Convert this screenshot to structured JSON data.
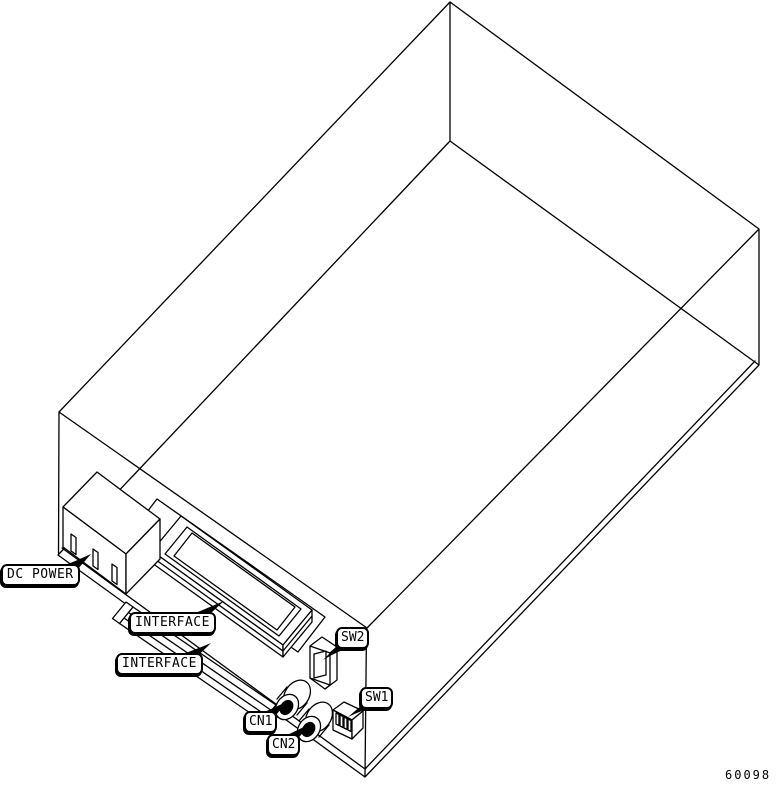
{
  "figure": {
    "number": "60098",
    "callouts": {
      "dc_power": "DC POWER",
      "interface_upper": "INTERFACE",
      "interface_lower": "INTERFACE",
      "sw2": "SW2",
      "sw1": "SW1",
      "cn1": "CN1",
      "cn2": "CN2"
    },
    "colors": {
      "line": "#000000",
      "background": "#ffffff"
    }
  }
}
